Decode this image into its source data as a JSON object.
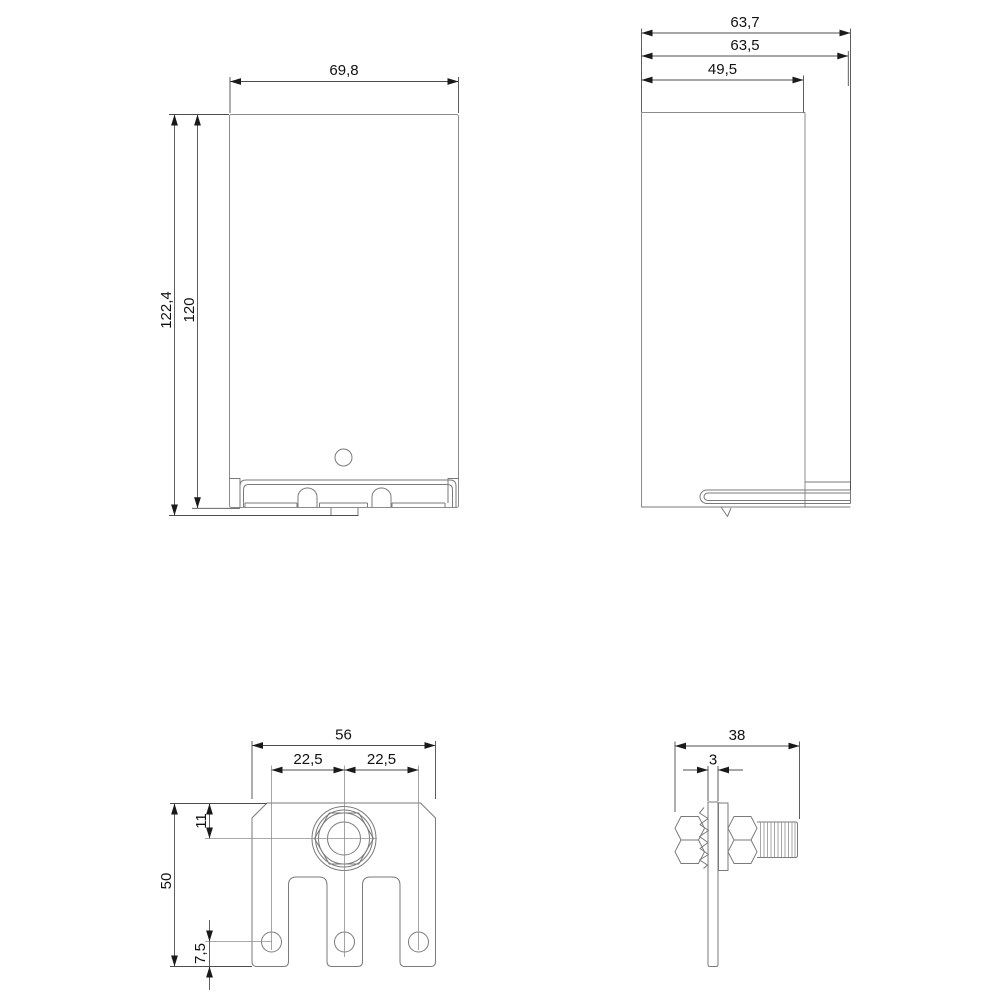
{
  "drawing": {
    "type": "dimensional-drawing",
    "views": {
      "front_view": {
        "name": "front view",
        "width": "69,8",
        "total_height": "122,4",
        "body_height": "120"
      },
      "side_view": {
        "name": "side view",
        "total_depth": "63,7",
        "depth": "63,5",
        "front_depth": "49,5"
      },
      "bottom_view": {
        "name": "bottom terminal bracket view",
        "width": "56",
        "pitch_left": "22,5",
        "pitch_right": "22,5",
        "height": "50",
        "stud_offset": "11",
        "hole_offset": "7,5"
      },
      "bolt_view": {
        "name": "fixing stud side view",
        "length": "38",
        "plate_thickness": "3"
      }
    },
    "colors": {
      "background": "#ffffff",
      "outline": "#7a7a7a",
      "dimension_line": "#4d4d4d",
      "text": "#111111"
    }
  }
}
